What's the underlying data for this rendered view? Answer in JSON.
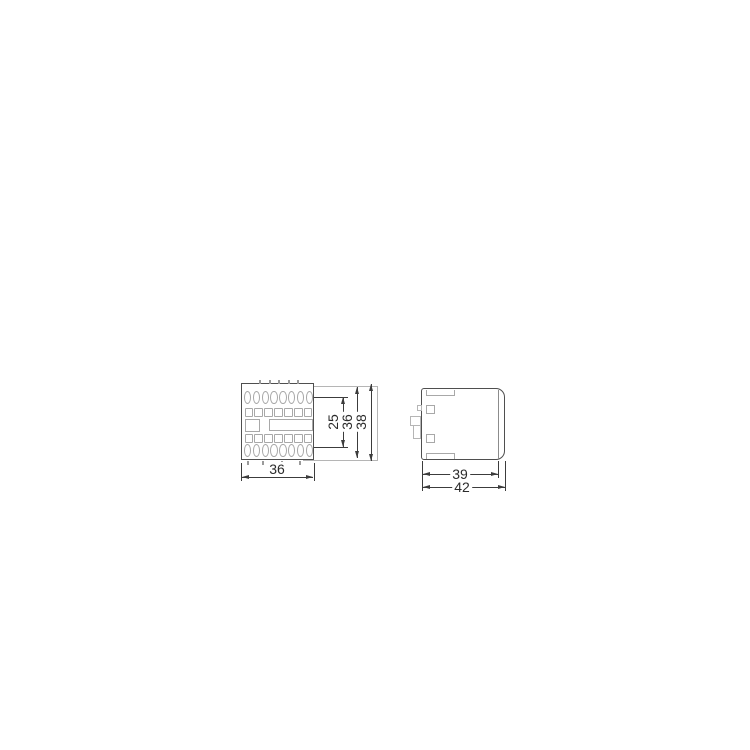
{
  "drawing": {
    "description": "dimensional-drawing-two-views",
    "views": {
      "front": {
        "bottom_width": {
          "label": "36"
        },
        "vertical_dims": [
          {
            "label": "25"
          },
          {
            "label": "36"
          },
          {
            "label": "38"
          }
        ],
        "terminal_rows": [
          {
            "type": "circle",
            "count": 8
          },
          {
            "type": "square",
            "count": 7
          },
          {
            "type": "square",
            "count": 7
          },
          {
            "type": "circle",
            "count": 8
          }
        ]
      },
      "side": {
        "bottom_dims": [
          {
            "label": "39"
          },
          {
            "label": "42"
          }
        ]
      }
    },
    "colors": {
      "background": "#ffffff",
      "outline": "#4f4f4f",
      "detail_line": "#a8a8a8",
      "phantom_line": "#b5b5b5",
      "dimension_line": "#3c3c3c",
      "text": "#2b2b2b"
    }
  }
}
